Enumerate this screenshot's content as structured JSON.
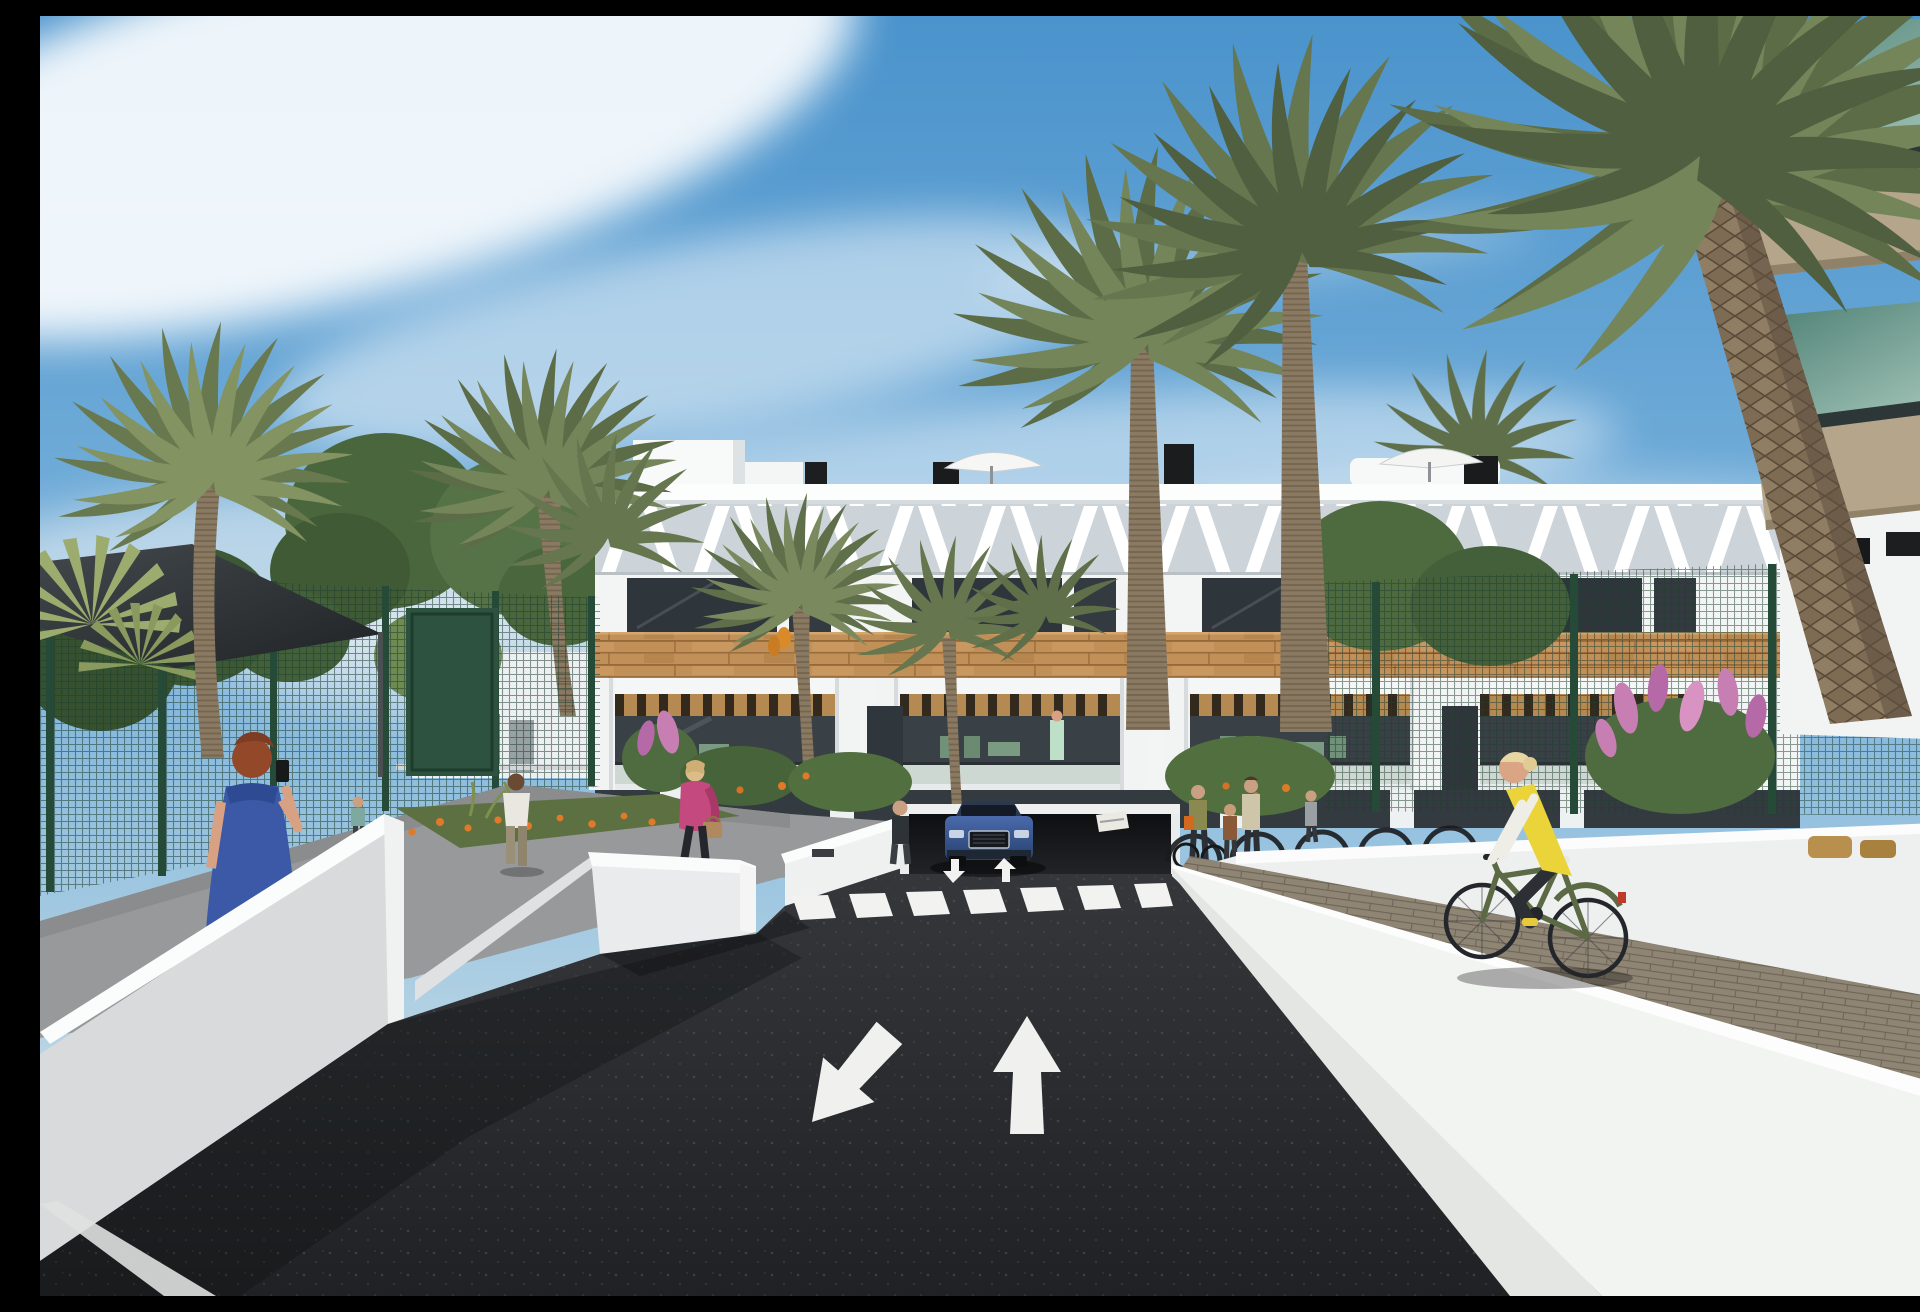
{
  "scene": {
    "type": "photorealistic architectural 3D render",
    "description": "Street-level visualization of a modern white Mediterranean apartment complex. A dark asphalt access road with a zebra crossing and two painted lane arrows leads to an underground parking ramp where a blue SUV is exiting. Pedestrians walk on a raised sidewalk behind white retaining walls on the left; a cyclist in a yellow vest rides a brick path on the right. Tall palm trees and flowering planters frame the view under a blue sky with wispy clouds.",
    "visible_text": "none",
    "people_count": 11,
    "vehicles": [
      "blue SUV",
      "bicycles"
    ],
    "colors": {
      "sky_top": "#4a93cc",
      "sky_mid": "#7db4dc",
      "sky_horizon": "#d8e6ec",
      "cloud": "#ffffff",
      "facade_white": "#f3f5f5",
      "louver_shade": "#ccd4d9",
      "wood_cladding": "#c09058",
      "window_glass": "#2e353b",
      "balcony_glass": "#a9bbb2",
      "asphalt": "#2a2b2e",
      "road_marking": "#f2f3f1",
      "wall_lit": "#fafbfb",
      "wall_shade": "#d9dadb",
      "sidewalk_gray": "#97999a",
      "brick_path": "#8f8575",
      "fence_green": "#264a38",
      "foliage_green": "#4e6b3d",
      "palm_frond": "#6d7d52",
      "palm_trunk": "#8a7a63",
      "flower_pink": "#c77fb3",
      "flower_orange": "#e07a28",
      "car_blue": "#3d5f9e",
      "vest_yellow": "#ead43a",
      "dress_blue": "#3b59a6",
      "jacket_pink": "#c4497f",
      "shade_sail": "#33383b",
      "glass_teal": "#4d7f74",
      "slab_tan": "#b4a58b"
    },
    "objects": [
      "sky",
      "clouds",
      "apartment-building",
      "rooftop-parasols",
      "rooftop-chimneys",
      "chevron-louvers",
      "wood-cladding-band",
      "balconies",
      "pergolas",
      "palm-trees",
      "fan-palm",
      "leafy-trees",
      "green-mesh-fence",
      "garden-gate",
      "shade-sail",
      "distant-buildings",
      "access-road",
      "zebra-crossing",
      "lane-arrow-forward",
      "lane-arrow-oncoming",
      "underground-garage-ramp",
      "blue-suv",
      "left-retaining-walls",
      "sidewalk",
      "planters",
      "orange-flowers",
      "pink-flower-bushes",
      "woman-blue-dress-phone",
      "woman-pink-jacket",
      "man-white-tshirt",
      "child-at-fence",
      "pedestrians-at-bike-racks",
      "bike-racks",
      "cyclist-yellow-vest",
      "brick-walkway",
      "right-retaining-walls",
      "foreground-balcony-building",
      "glass-balustrades"
    ]
  }
}
